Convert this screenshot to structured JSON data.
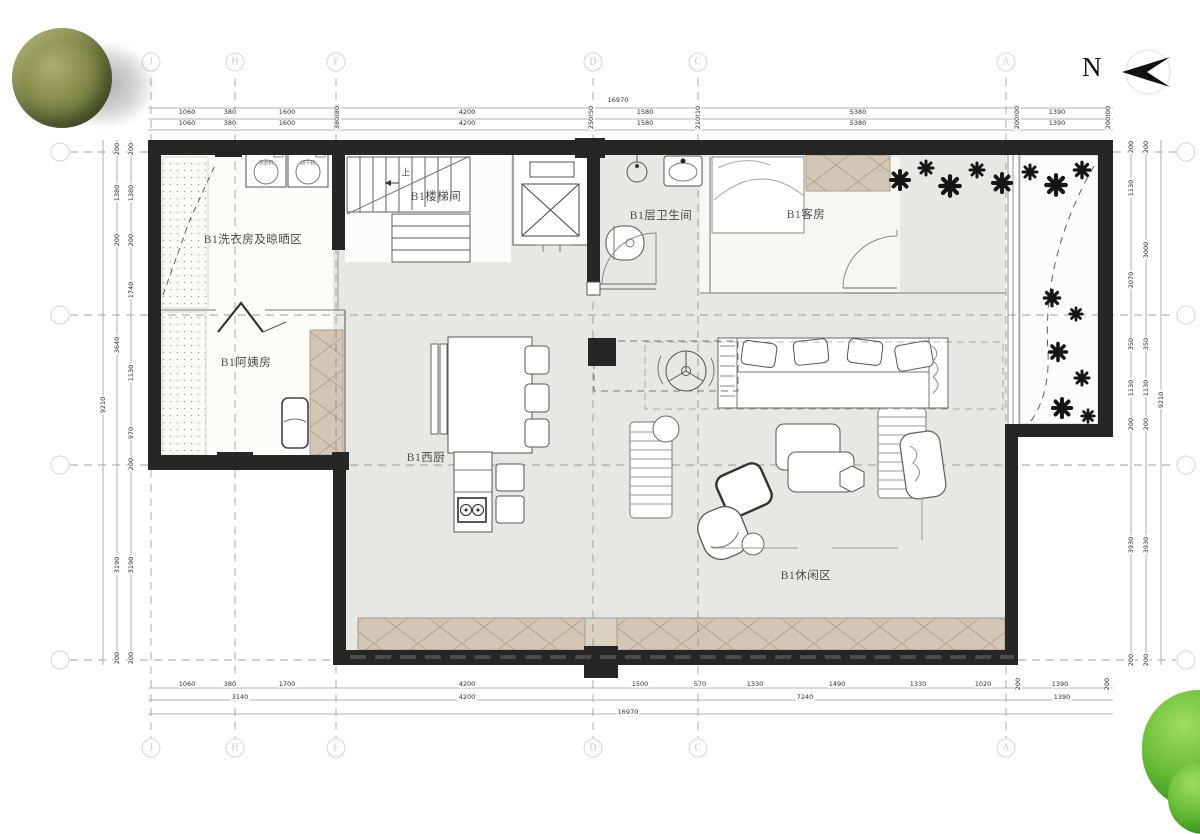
{
  "meta": {
    "north_label": "N"
  },
  "rooms": {
    "laundry": "B1洗衣房及晾晒区",
    "stairwell": "B1楼梯间",
    "up": "上",
    "bathroom": "B1层卫生间",
    "guest": "B1客房",
    "nanny": "B1阿姨房",
    "kitchen": "B1西厨",
    "leisure": "B1休闲区",
    "washer": "洗衣机",
    "dryer": "烘干机"
  },
  "grids": {
    "vertical": [
      "J",
      "H",
      "F",
      "D",
      "C",
      "A"
    ],
    "horizontal_rows": [
      "",
      "",
      "",
      ""
    ]
  },
  "dimensions": {
    "top_total": "16970",
    "top_row1": [
      "1060",
      "380",
      "1600",
      "380",
      "4200",
      "250",
      "1580",
      "210",
      "5380",
      "200",
      "1390",
      "200"
    ],
    "top_row2": [
      "1060",
      "380",
      "1600",
      "380",
      "4200",
      "250",
      "1580",
      "210",
      "5380",
      "200",
      "1390",
      "200"
    ],
    "bottom_row1": [
      "1060",
      "380",
      "1700",
      "4200",
      "1500",
      "570",
      "1330",
      "1490",
      "1330",
      "1020",
      "200",
      "1390",
      "200"
    ],
    "bottom_row2": [
      "3140",
      "4200",
      "7240",
      "1390"
    ],
    "bottom_total": "16970",
    "left_inner": [
      "200",
      "1380",
      "200",
      "1740",
      "1130",
      "970",
      "200",
      "3190",
      "200"
    ],
    "left_mid": [
      "200",
      "1380",
      "200",
      "3640",
      "3190",
      "200"
    ],
    "left_outer": "9210",
    "right_inner": [
      "200",
      "1130",
      "2070",
      "350",
      "1130",
      "200",
      "3930",
      "200"
    ],
    "right_mid": [
      "200",
      "3000",
      "350",
      "1130",
      "200",
      "3930",
      "200"
    ],
    "right_outer": "9210"
  },
  "colors": {
    "wall": "#262626",
    "floor": "#e7e8e4",
    "cabinet_tan": "#d3c6b4",
    "tree_olive": "#6e7840",
    "bush_green": "#4da32b"
  }
}
